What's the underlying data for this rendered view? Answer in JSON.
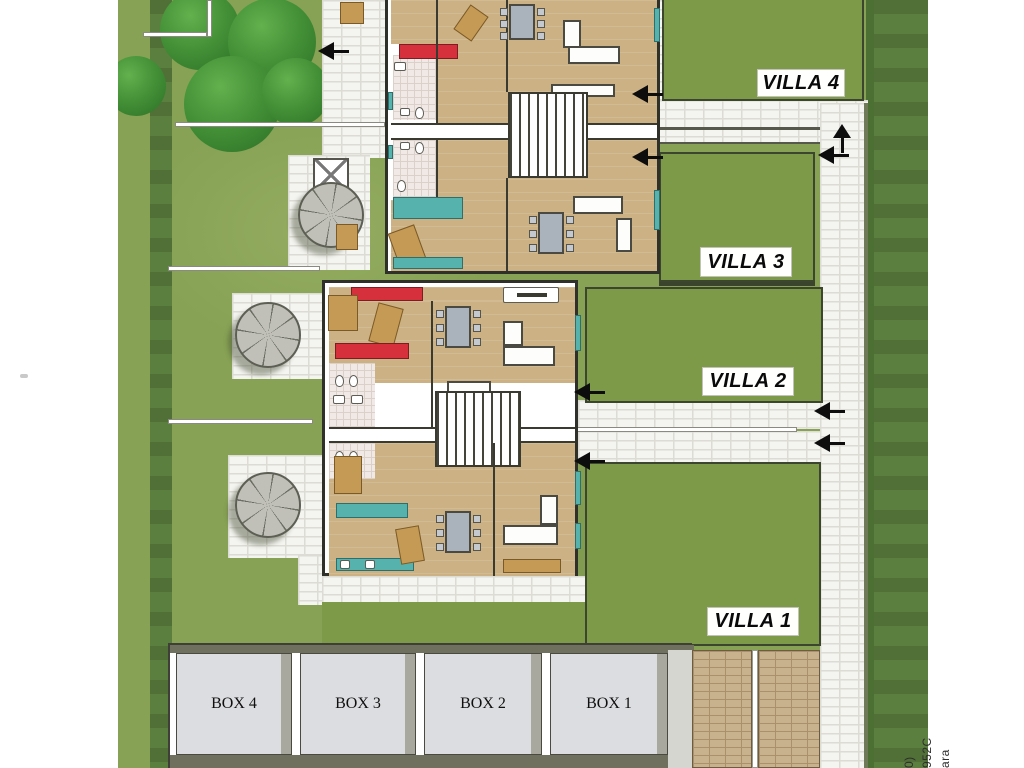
{
  "labels": {
    "villa_4": "VILLA 4",
    "villa_3": "VILLA 3",
    "villa_2": "VILLA 2",
    "villa_1": "VILLA 1",
    "box_4": "BOX 4",
    "box_3": "BOX 3",
    "box_2": "BOX 2",
    "box_1": "BOX 1"
  },
  "watermark": {
    "fragments": [
      "0)",
      "952C",
      "ara"
    ]
  },
  "palette": {
    "grass": "#87a254",
    "lawn": "#7d9a49",
    "hedge_dark": "#5b7f3f",
    "paving_light": "#f4f4f0",
    "paving_tan": "#c8b28d",
    "floor_tan": "#ccb184",
    "furniture_red": "#d5303c",
    "furniture_teal": "#56b2ac",
    "garage_fill": "#dcdde0",
    "arrow_black": "#0d0d0d"
  }
}
